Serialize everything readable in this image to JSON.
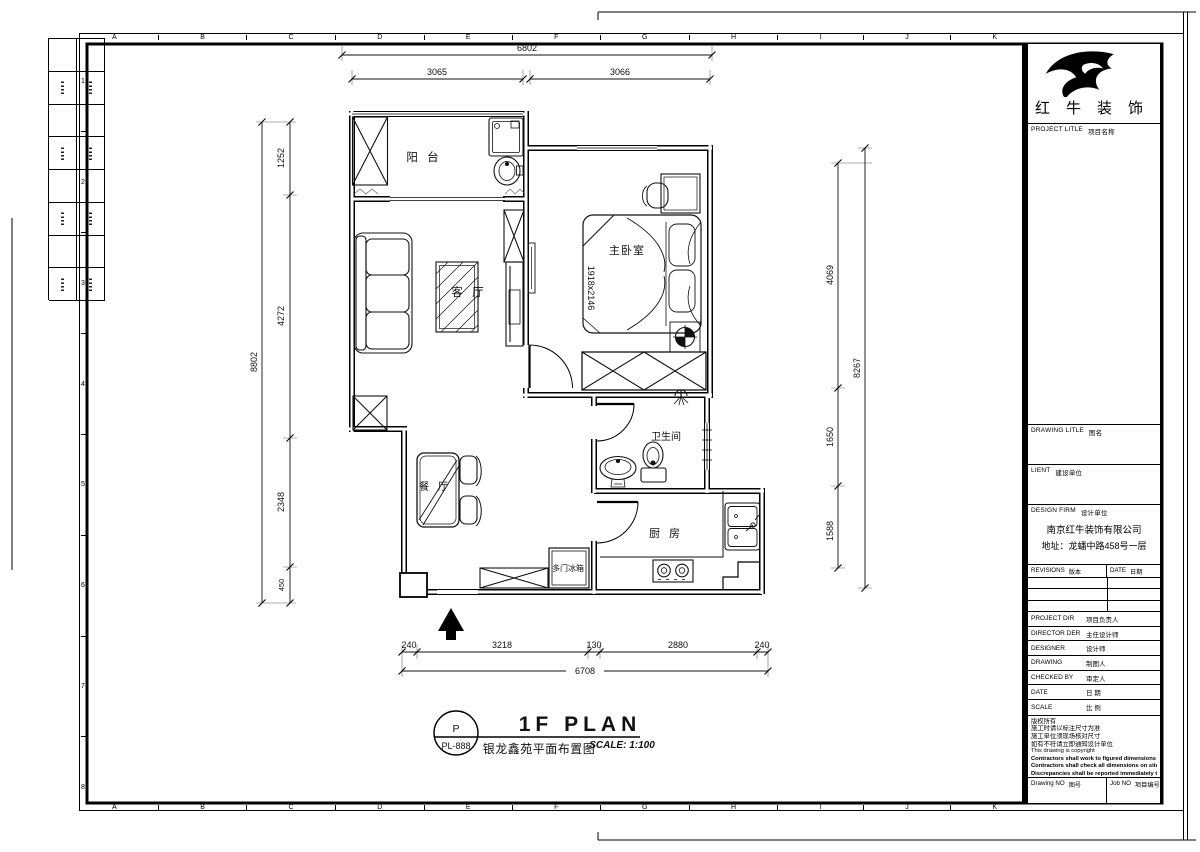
{
  "sheet": {
    "brand": "红牛装饰",
    "grid_letters": [
      "A",
      "B",
      "C",
      "D",
      "E",
      "F",
      "G",
      "H",
      "I",
      "J",
      "K"
    ],
    "grid_numbers": [
      "1",
      "2",
      "3",
      "4",
      "5",
      "6",
      "7",
      "8"
    ]
  },
  "plan": {
    "rooms": {
      "balcony": "阳 台",
      "living": "客 厅",
      "bedroom": "主卧室",
      "bathroom": "卫生间",
      "kitchen": "厨 房",
      "dining": "餐 厅"
    },
    "labels": {
      "bed_size": "1918x2146",
      "fridge": "多门冰箱"
    },
    "dims": {
      "top_overall": "6802",
      "top_seg1": "3065",
      "top_seg2": "3066",
      "left_overall": "8802",
      "left_seg1": "1252",
      "left_seg2": "4272",
      "left_seg3": "2348",
      "left_seg4": "450",
      "right_overall": "8267",
      "right_seg1": "4069",
      "right_seg2": "1650",
      "right_seg3": "1588",
      "bottom_overall": "6708",
      "bottom_seg1": "240",
      "bottom_seg2": "3218",
      "bottom_seg3": "130",
      "bottom_seg4": "2880",
      "bottom_seg5": "240"
    }
  },
  "titlebar": {
    "callout_top": "P",
    "callout_bottom": "PL-888",
    "title": "1F PLAN",
    "subtitle": "银龙鑫苑平面布置图",
    "scale": "SCALE: 1:100"
  },
  "titleblock": {
    "project_en": "PROJECT LITLE",
    "project_cn": "项目名称",
    "drawing_title_en": "DRAWING LITLE",
    "drawing_title_cn": "图名",
    "client_en": "LIENT",
    "client_cn": "建设单位",
    "firm_en": "DESIGN FIRM",
    "firm_cn": "设计单位",
    "firm_name": "南京红牛装饰有限公司",
    "firm_address": "地址：龙蟠中路458号一层",
    "revisions_en": "REVISIONS",
    "revisions_cn": "版本",
    "date_col_en": "DATE",
    "date_col_cn": "日期",
    "pd_en": "PROJECT DIR",
    "pd_cn": "项目负责人",
    "dd_en": "DIRECTOR DER",
    "dd_cn": "主任设计师",
    "de_en": "DESIGNER",
    "de_cn": "设计师",
    "dr_en": "DRAWING",
    "dr_cn": "制图人",
    "cb_en": "CHECKED BY",
    "cb_cn": "审定人",
    "dt_en": "DATE",
    "dt_cn": "日 期",
    "sc_en": "SCALE",
    "sc_cn": "比 例",
    "notes": [
      "版权所有",
      "施工时请以标注尺寸为准",
      "施工单位须现场核对尺寸",
      "如有不符请立即通知设计单位",
      "This drawing is copyright",
      "Contractors shall work to figured dimensions only",
      "Contractors shall check all dimensions on site",
      "Discrepancies shall be reported immediately to architects"
    ],
    "drawing_no_en": "Drawing NO",
    "drawing_no_cn": "图号",
    "job_no_en": "Job NO",
    "job_no_cn": "项目编号"
  }
}
